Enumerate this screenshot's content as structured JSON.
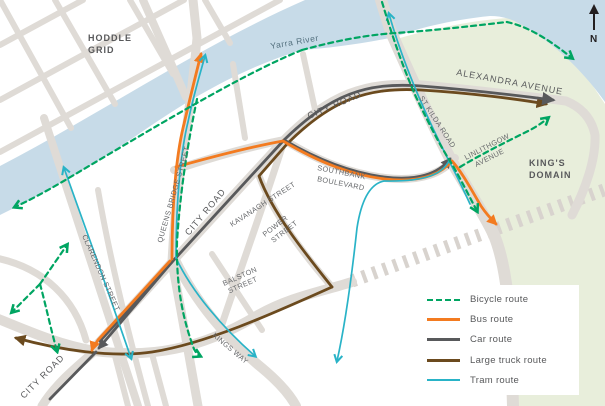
{
  "title": "Southbank transport routes map",
  "compass": {
    "label": "N"
  },
  "areas": {
    "hoddle_grid": [
      "HODDLE",
      "GRID"
    ],
    "kings_domain": [
      "KING'S",
      "DOMAIN"
    ],
    "yarra_river": "Yarra River"
  },
  "streets": {
    "alexandra_avenue": "ALEXANDRA AVENUE",
    "city_road_upper": "CITY ROAD",
    "city_road_mid": "CITY ROAD",
    "city_road_lower": "CITY ROAD",
    "queens_bridge_street": "QUEENS BRIDGE STREET",
    "clarendon_street": "CLARENDON STREET",
    "kavanagh_street": "KAVANAGH STREET",
    "power_street": [
      "POWER",
      "STREET"
    ],
    "balston_street": [
      "BALSTON",
      "STREET"
    ],
    "kings_way": "KINGS WAY",
    "st_kilda_road": "ST KILDA ROAD",
    "southbank_boulevard": [
      "SOUTHBANK",
      "BOULEVARD"
    ],
    "linlithgow_avenue": [
      "LINLITHGOW",
      "AVENUE"
    ]
  },
  "legend": {
    "items": [
      {
        "label": "Bicycle route",
        "type": "bicycle",
        "color": "#00a562",
        "style": "dashed"
      },
      {
        "label": "Bus route",
        "type": "bus",
        "color": "#f37b20",
        "style": "solid"
      },
      {
        "label": "Car route",
        "type": "car",
        "color": "#58595b",
        "style": "solid"
      },
      {
        "label": "Large truck route",
        "type": "truck",
        "color": "#6b4a1e",
        "style": "solid"
      },
      {
        "label": "Tram route",
        "type": "tram",
        "color": "#29b3c7",
        "style": "thin-solid"
      }
    ]
  },
  "colors": {
    "river": "#c7dbe8",
    "park": "#e8eedb",
    "road": "#dfdbd6",
    "bicycle_route": "#00a562",
    "bus_route": "#f37b20",
    "car_route": "#58595b",
    "truck_route": "#6b4a1e",
    "tram_route": "#29b3c7",
    "label_text": "#58595b"
  }
}
